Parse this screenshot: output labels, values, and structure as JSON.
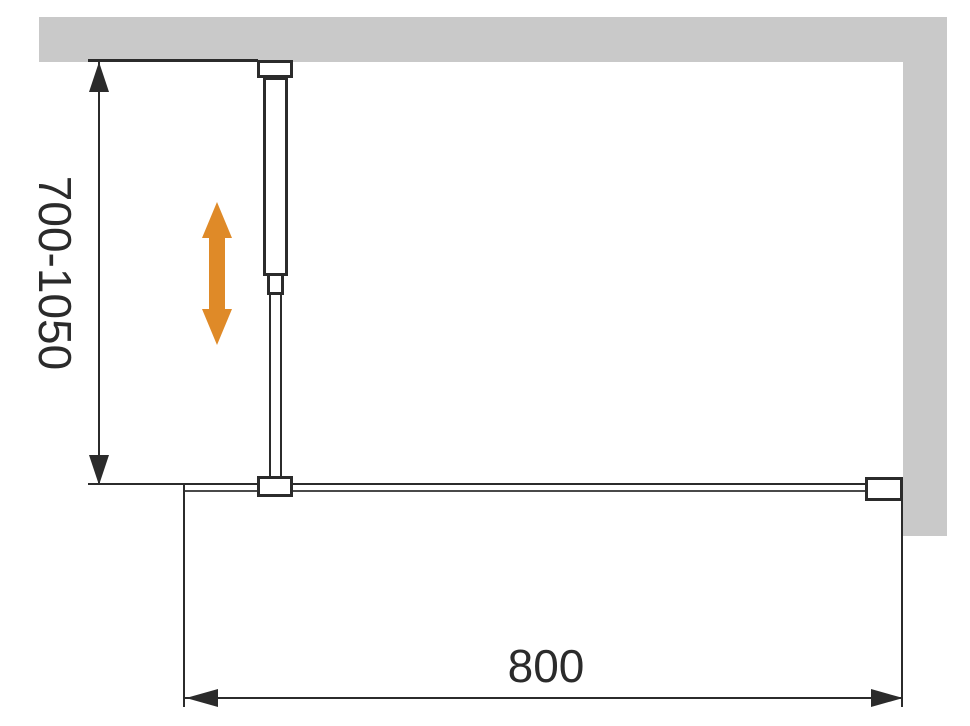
{
  "diagram": {
    "type": "technical-installation-drawing",
    "subject": "walk-in shower glass screen with adjustable support bar (front view)",
    "labels": {
      "height_range": "700-1050",
      "width": "800"
    },
    "colors": {
      "wall_fill": "#c9c9c9",
      "line": "#2b2b2b",
      "accent_arrow": "#df8a28",
      "background": "#ffffff"
    },
    "components": [
      "ceiling-wall",
      "side-wall",
      "support-bar-wall-bracket",
      "support-bar-tube",
      "support-bar-collar",
      "support-bar-rod",
      "glass-clamp",
      "glass-panel",
      "glass-wall-profile",
      "adjustability-arrow"
    ]
  }
}
